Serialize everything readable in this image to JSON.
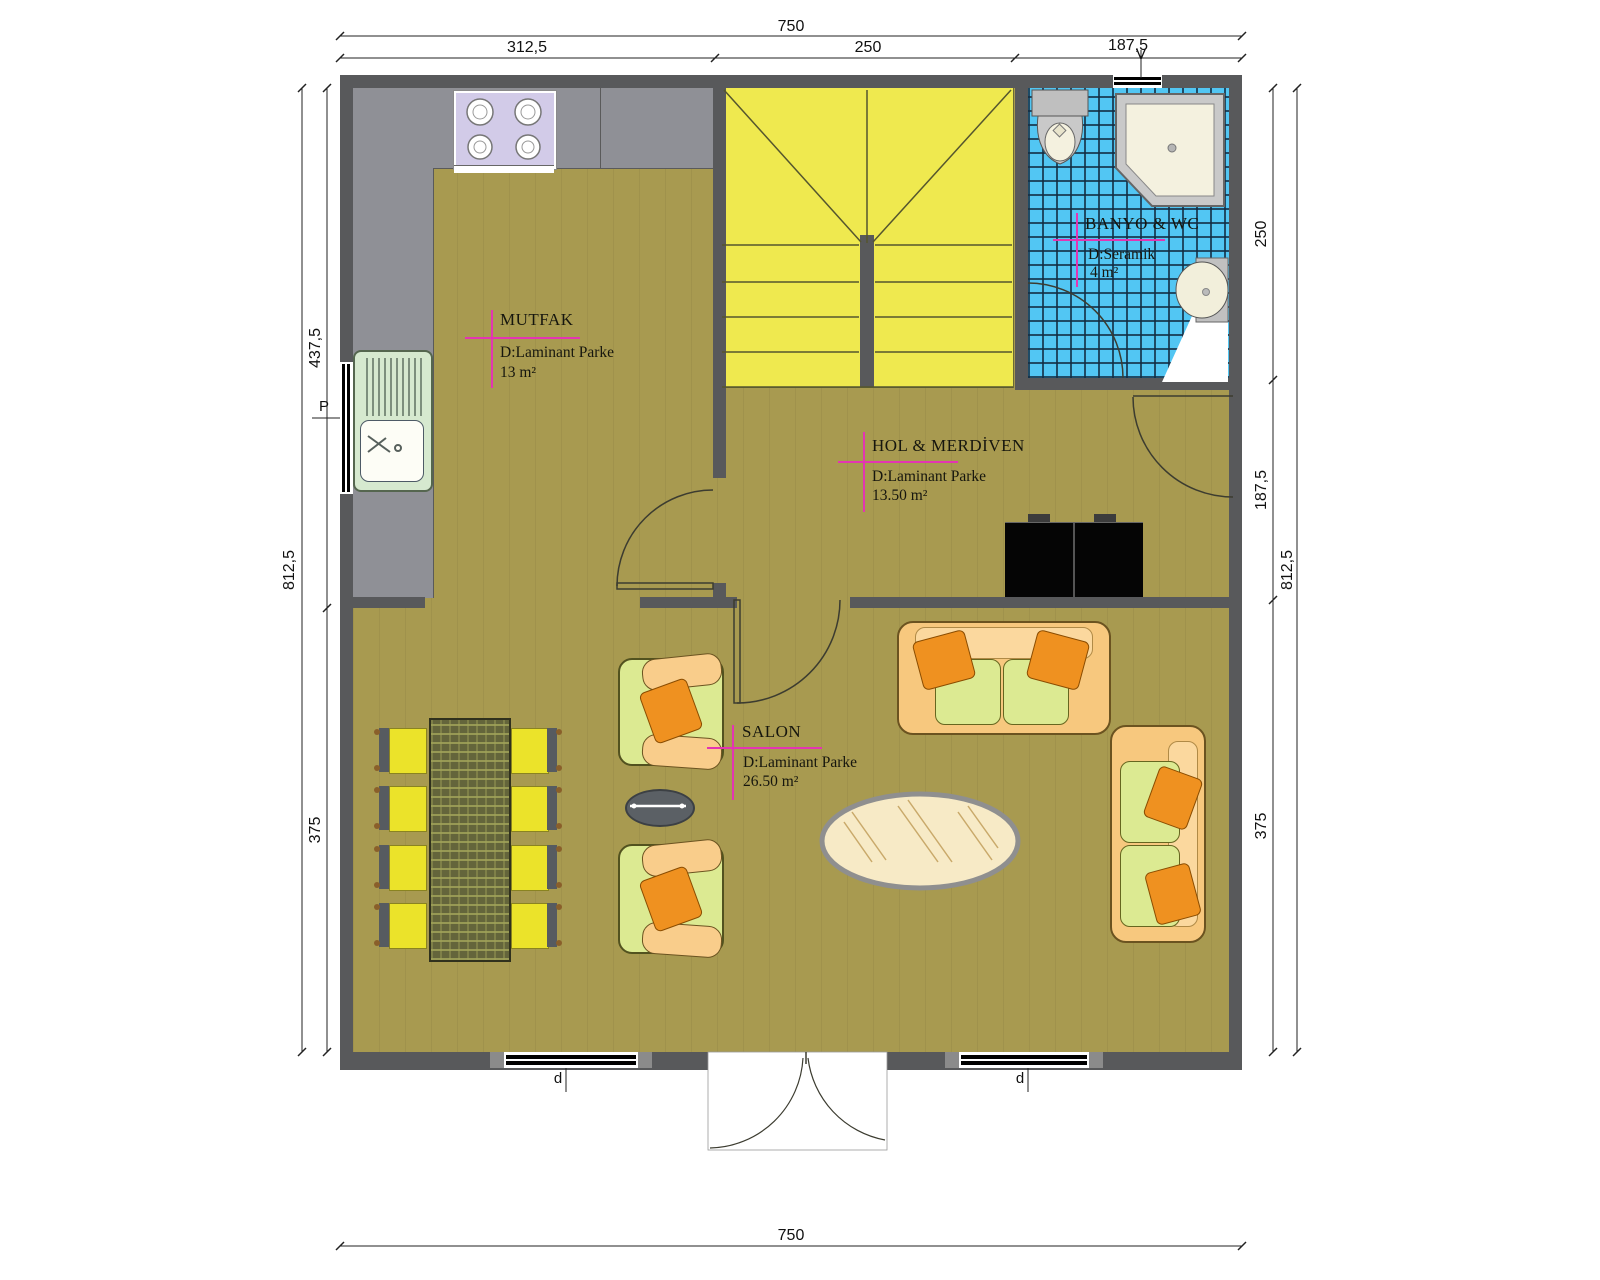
{
  "plan": {
    "rooms": [
      {
        "id": "mutfak",
        "name": "MUTFAK",
        "floor": "D:Laminant Parke",
        "area": "13  m²"
      },
      {
        "id": "banyo",
        "name": "BANYO & WC",
        "floor": "D:Seramik",
        "area": "4  m²"
      },
      {
        "id": "hol",
        "name": "HOL & MERDİVEN",
        "floor": "D:Laminant Parke",
        "area": "13.50  m²"
      },
      {
        "id": "salon",
        "name": "SALON",
        "floor": "D:Laminant Parke",
        "area": "26.50 m²"
      }
    ],
    "dimensions": {
      "top": {
        "total": "750",
        "segments": [
          "312,5",
          "250",
          "187,5"
        ]
      },
      "bottom": {
        "total": "750"
      },
      "left": {
        "total": "812,5",
        "segments": [
          "437,5",
          "375"
        ]
      },
      "right": {
        "total": "812,5",
        "segments": [
          "250",
          "187,5",
          "375"
        ]
      }
    },
    "markers": {
      "top_window": "V",
      "left_window": "P",
      "bottom_left_window": "d",
      "bottom_right_window": "d"
    },
    "colors": {
      "floor": "#a89a50",
      "wall": "#58595b",
      "stairs": "#efe94f",
      "tile": "#52c6f3",
      "accent_magenta": "#e335b2",
      "chair_yellow": "#ebe32a",
      "sofa_peach": "#f7c87e",
      "cushion_green": "#dcea92",
      "pillow_orange": "#ef9120"
    }
  }
}
